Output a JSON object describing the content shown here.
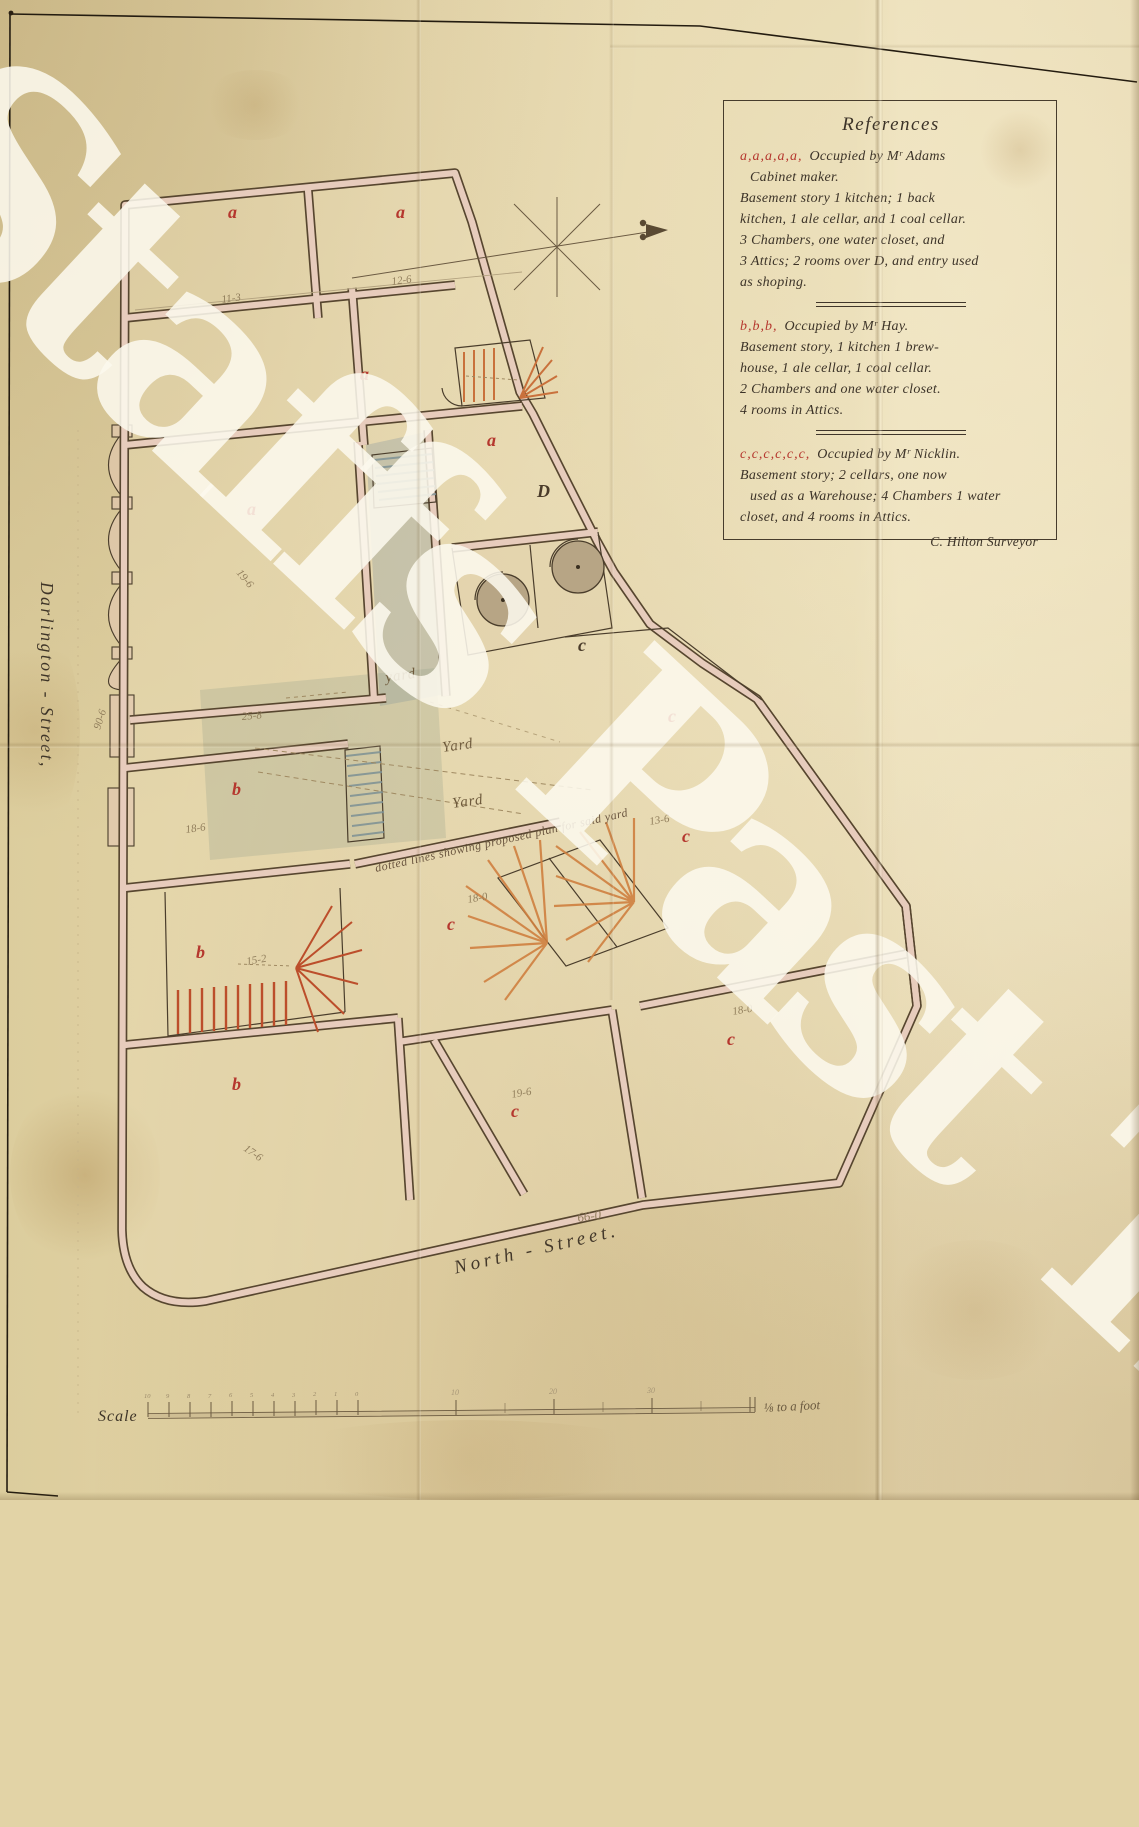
{
  "watermark_text": "Staffs Past Track",
  "references": {
    "title": "References",
    "sections": [
      {
        "prefix": "a,a,a,a,a,",
        "head": "Occupied by Mʳ Adams",
        "lines": [
          "Cabinet maker.",
          "Basement story 1 kitchen; 1 back",
          "kitchen, 1 ale cellar, and 1 coal cellar.",
          "3 Chambers, one water closet, and",
          "3 Attics; 2 rooms over D, and entry used",
          "as shoping."
        ]
      },
      {
        "prefix": "b,b,b,",
        "head": "Occupied by Mʳ Hay.",
        "lines": [
          "Basement story, 1 kitchen 1 brew-",
          "house, 1 ale cellar, 1 coal cellar.",
          "2 Chambers and one water closet.",
          "4 rooms in Attics."
        ]
      },
      {
        "prefix": "c,c,c,c,c,c,",
        "head": "Occupied by Mʳ Nicklin.",
        "lines": [
          "Basement story; 2 cellars, one now",
          "used as a Warehouse; 4 Chambers 1 water",
          "closet, and 4 rooms in Attics."
        ]
      }
    ],
    "signature": "C. Hilton Surveyor"
  },
  "streets": {
    "left": "Darlington - Street,",
    "bottom": "North - Street."
  },
  "scale": {
    "label": "Scale",
    "unit": "⅛ to a foot",
    "minor_labels": [
      "10",
      "9",
      "8",
      "7",
      "6",
      "5",
      "4",
      "3",
      "2",
      "1",
      "0"
    ],
    "major_labels": [
      "10",
      "20",
      "30"
    ]
  },
  "plan": {
    "room_labels": [
      "a",
      "a",
      "a",
      "a",
      "a",
      "D",
      "c",
      "c",
      "b",
      "c",
      "b",
      "c",
      "b",
      "c",
      "c"
    ],
    "dimensions": [
      "12-6",
      "11-3",
      "19-6",
      "25-8",
      "18-6",
      "15-2",
      "17-6",
      "18-0",
      "13-6",
      "19-6",
      "18-0",
      "66-0",
      "90-6"
    ],
    "yard_labels": [
      "yard",
      "Yard",
      "Yard"
    ],
    "note": "dotted lines showing proposed plan for said yard"
  },
  "colors": {
    "paper": "#e2d3a6",
    "ink": "#46392a",
    "red_label": "#b5372e",
    "wall_pink": "#e7ccbc",
    "stair_orange": "#cf8040",
    "stair_red": "#bc4e2b",
    "wash_blue_grey": "#8fa0a0",
    "pencil": "#8d7a58",
    "watermark": "#fcf8ed"
  }
}
